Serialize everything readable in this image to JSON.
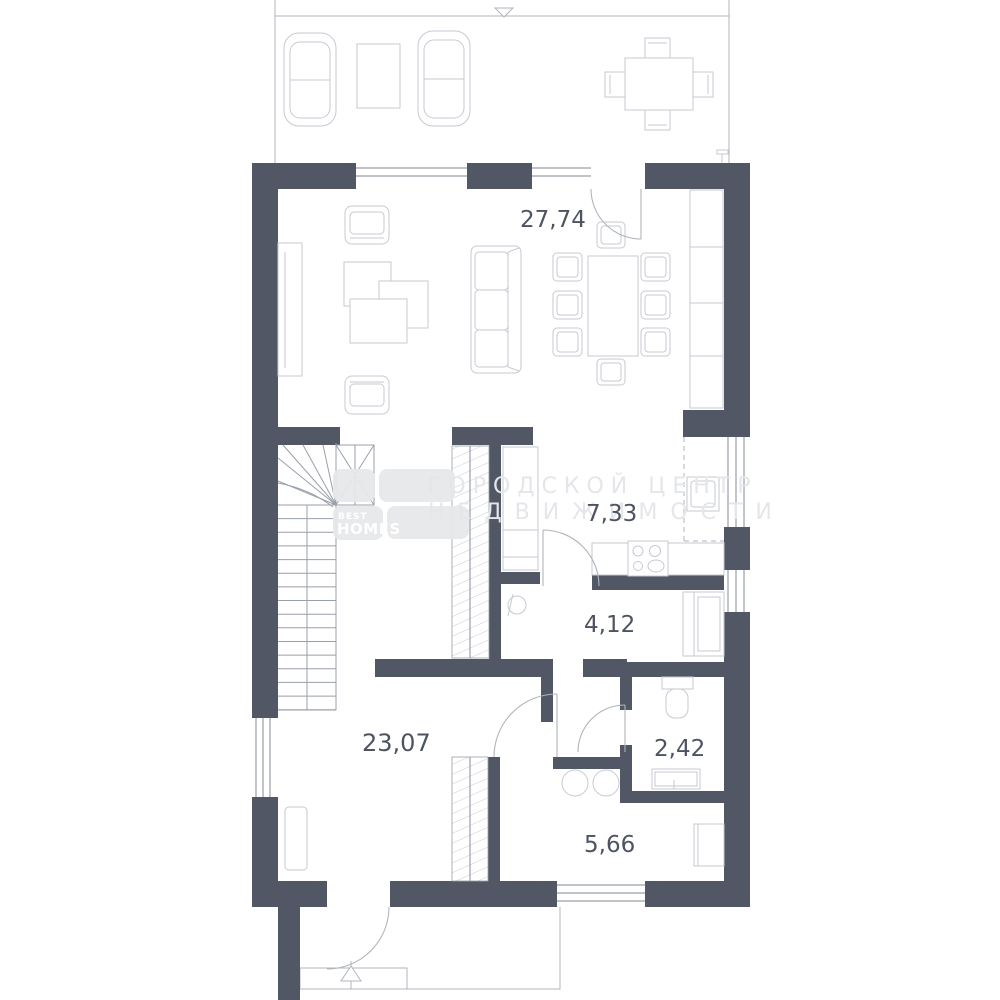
{
  "page": {
    "type": "floor-plan",
    "background": "#ffffff"
  },
  "watermark": {
    "line1": "ГОРОДСКОЙ ЦЕНТР",
    "line2": "НЕДВИЖИМОСТИ"
  },
  "logo": {
    "line1": "BEST",
    "line2": "HOMES"
  },
  "rooms": {
    "living_room": {
      "area": "27,74"
    },
    "kitchen": {
      "area": "7,33"
    },
    "hallway": {
      "area": "4,12"
    },
    "wc": {
      "area": "2,42"
    },
    "bathroom": {
      "area": "5,66"
    },
    "hall": {
      "area": "23,07"
    }
  },
  "colors": {
    "wall": "#515765",
    "line": "#c6cad0",
    "door": "#b0b5bc",
    "window": "#9aa0a9",
    "stair": "#9aa0a9",
    "label": "#4d5360",
    "watermark": "#e4e6e9",
    "logo_block": "#e6e8ea"
  }
}
